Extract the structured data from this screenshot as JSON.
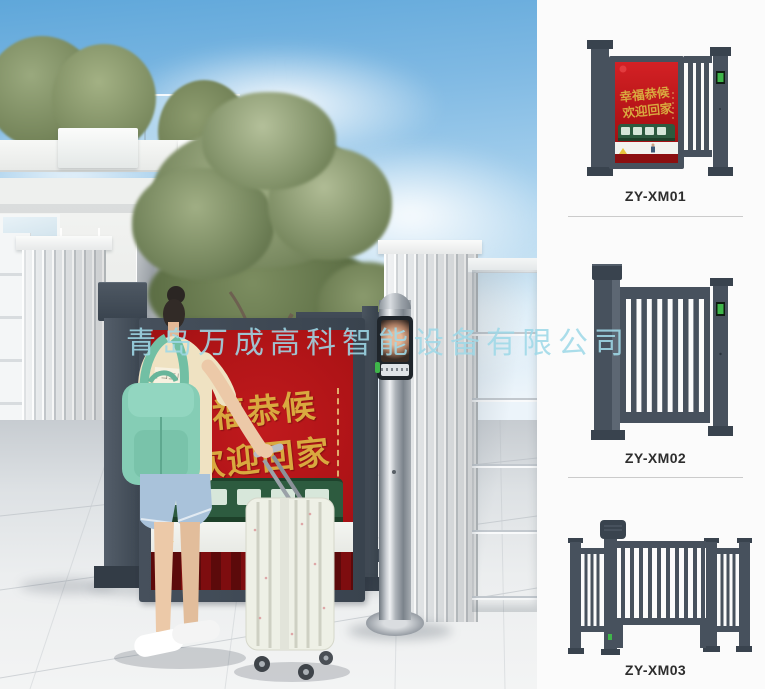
{
  "watermark": {
    "text": "青岛万成高科智能设备有限公司",
    "color": "#9fd9e8"
  },
  "scene": {
    "ad_panel": {
      "line1": "幸福恭候",
      "line2": "欢迎回家"
    },
    "shirt_tag": "キコ三川"
  },
  "catalog": {
    "products": [
      {
        "model": "ZY-XM01",
        "ad_line1": "幸福恭候",
        "ad_line2": "欢迎回家"
      },
      {
        "model": "ZY-XM02"
      },
      {
        "model": "ZY-XM03"
      }
    ]
  },
  "colors": {
    "gate_dark": "#47515d",
    "gate_darker": "#39434e",
    "ad_red": "#c01a1d",
    "ad_gold": "#d9a93f",
    "train_green": "#2c5a3e",
    "keypad_green": "#3fb54a",
    "backpack_teal": "#85cdb5",
    "watermark": "#9fd9e8",
    "label_text": "#2d2d2d",
    "divider": "#cbcbcb"
  }
}
